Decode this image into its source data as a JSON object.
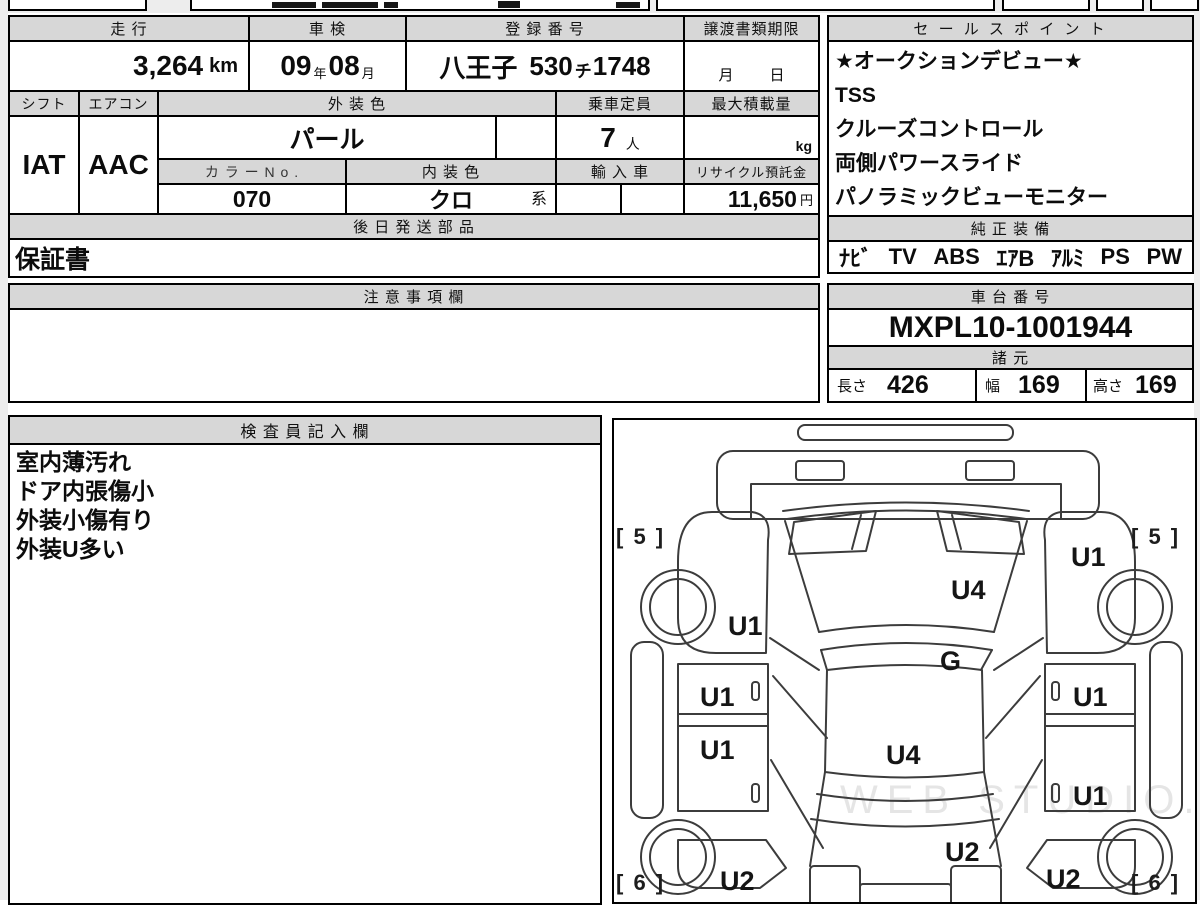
{
  "colors": {
    "header_bg": "#d7d7d7",
    "border": "#000000",
    "margin_bg": "#ededed",
    "page_bg": "#ffffff"
  },
  "top_table": {
    "mileage": {
      "label": "走 行",
      "value": "3,264",
      "unit": "km"
    },
    "inspection": {
      "label": "車 検",
      "year": "09",
      "year_unit": "年",
      "month": "08",
      "month_unit": "月"
    },
    "registration": {
      "label": "登 録 番 号",
      "office": "八王子",
      "class_no": "530",
      "kana": "チ",
      "number": "1748"
    },
    "transfer_deadline": {
      "label": "譲渡書類期限",
      "month_label": "月",
      "day_label": "日"
    },
    "shift": {
      "label": "シフト",
      "value": "IAT"
    },
    "aircon": {
      "label": "エアコン",
      "value": "AAC"
    },
    "exterior_color": {
      "label": "外 装 色",
      "value": "パール"
    },
    "capacity": {
      "label": "乗車定員",
      "value": "7",
      "unit": "人"
    },
    "max_load": {
      "label": "最大積載量",
      "unit": "kg"
    },
    "color_no": {
      "label": "カ ラ ー N o .",
      "value": "070"
    },
    "interior_color": {
      "label": "内 装 色",
      "value": "クロ",
      "suffix": "系"
    },
    "import_car": {
      "label": "輸 入 車"
    },
    "recycle_deposit": {
      "label": "リサイクル預託金",
      "value": "11,650",
      "unit": "円"
    },
    "later_parts": {
      "label": "後 日 発 送 部 品",
      "value": "保証書"
    }
  },
  "sales_point": {
    "label": "セ ー ル ス ポ イ ン ト",
    "items": [
      "★オークションデビュー★",
      "TSS",
      "クルーズコントロール",
      "両側パワースライド",
      "パノラミックビューモニター"
    ]
  },
  "genuine_equipment": {
    "label": "純 正 装 備",
    "items": [
      "ﾅﾋﾞ",
      "TV",
      "ABS",
      "ｴｱB",
      "ｱﾙﾐ",
      "PS",
      "PW"
    ]
  },
  "notes_section": {
    "label": "注 意 事 項 欄",
    "value": ""
  },
  "chassis": {
    "label": "車 台 番 号",
    "value": "MXPL10-1001944"
  },
  "specs": {
    "label": "諸 元",
    "length_label": "長さ",
    "length": "426",
    "width_label": "幅",
    "width": "169",
    "height_label": "高さ",
    "height": "169"
  },
  "inspector_notes": {
    "label": "検 査 員 記 入 欄",
    "lines": [
      "室内薄汚れ",
      "ドア内張傷小",
      "外装小傷有り",
      "外装U多い"
    ]
  },
  "diagram": {
    "watermark": "WEB STUDIO.PRO",
    "corner_grades": {
      "front_left": "[ 5 ]",
      "front_right": "[ 5 ]",
      "rear_left": "[ 6 ]",
      "rear_right": "[ 6 ]"
    },
    "marks": [
      {
        "code": "U1",
        "part": "left-front-fender"
      },
      {
        "code": "U1",
        "part": "right-front-fender"
      },
      {
        "code": "U4",
        "part": "hood"
      },
      {
        "code": "G",
        "part": "windshield"
      },
      {
        "code": "U1",
        "part": "left-front-door"
      },
      {
        "code": "U1",
        "part": "left-rear-door"
      },
      {
        "code": "U4",
        "part": "roof"
      },
      {
        "code": "U1",
        "part": "right-front-door"
      },
      {
        "code": "U1",
        "part": "right-rear-door"
      },
      {
        "code": "U2",
        "part": "left-rear-quarter"
      },
      {
        "code": "U2",
        "part": "rear-gate"
      },
      {
        "code": "U2",
        "part": "right-rear-quarter"
      }
    ]
  }
}
